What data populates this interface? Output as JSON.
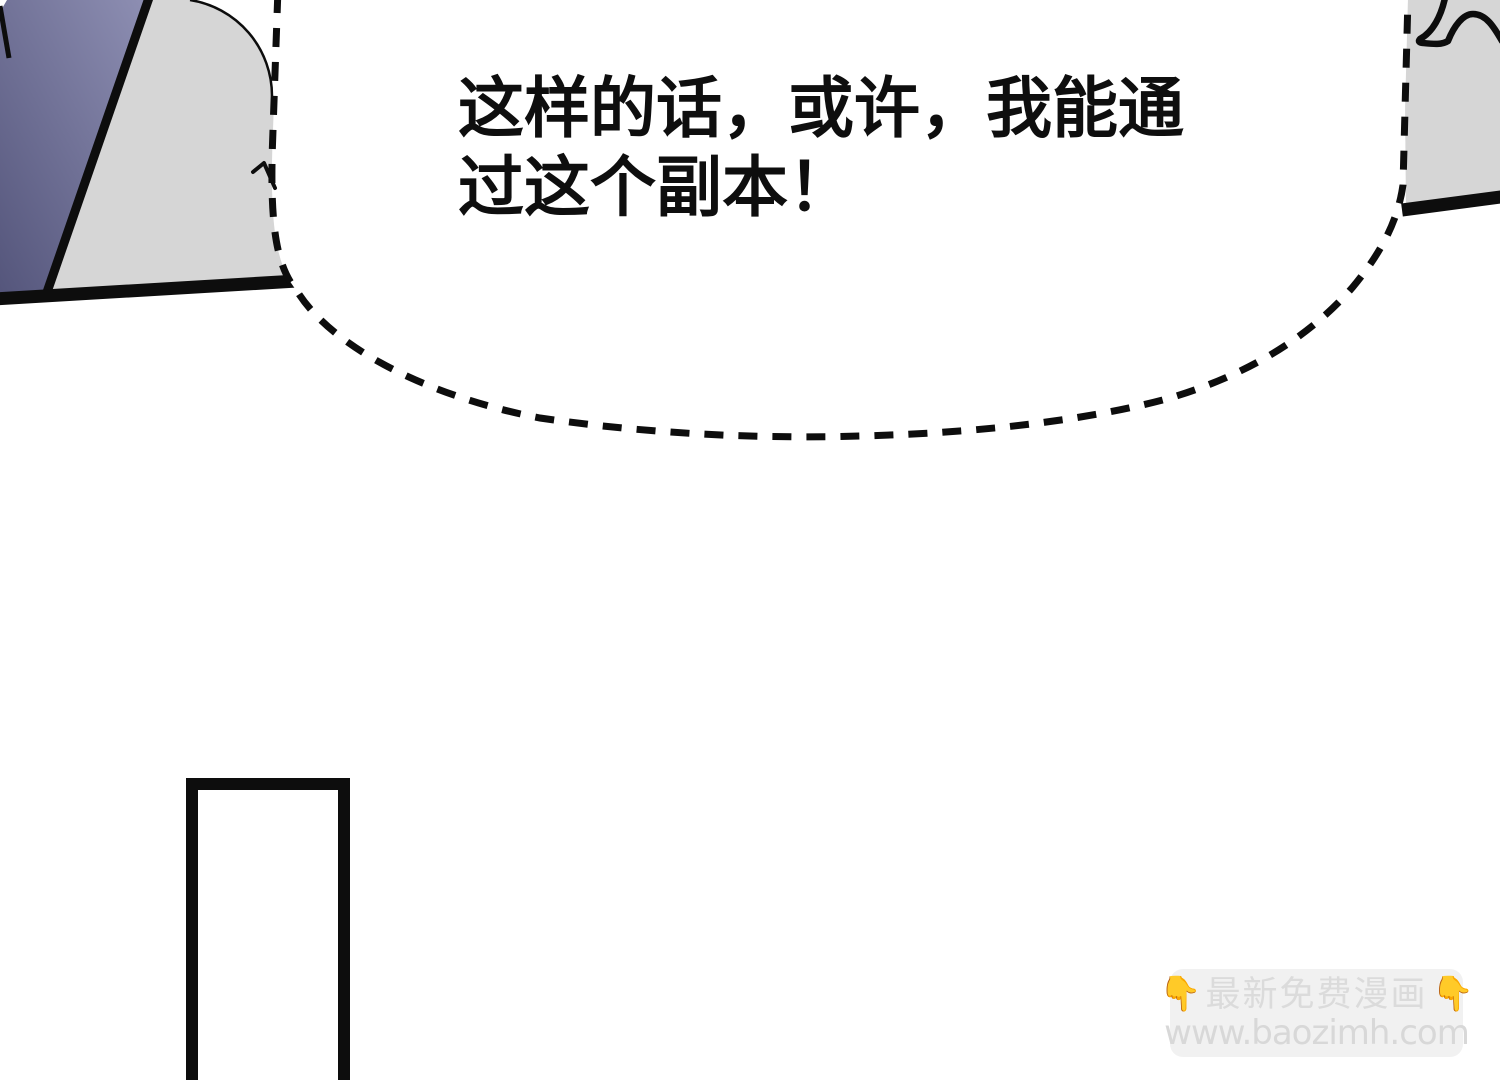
{
  "page": {
    "background": "#ffffff",
    "width": 1500,
    "height": 1080
  },
  "speech_bubble": {
    "text": "这样的话，或许，我能通\n过这个副本！",
    "fill": "#ffffff",
    "border_color": "#0d0d0d",
    "border_style": "dashed",
    "text_color": "#0e0e0e"
  },
  "art": {
    "panel_fill": "#d6d6d6",
    "ink_color": "#0d0d0d",
    "background_white": "#ffffff",
    "sword": {
      "color_dark": "#53547a",
      "color_light": "#8f90b4"
    }
  },
  "watermark": {
    "emoji_left": "👇",
    "title": "最新免费漫画",
    "emoji_right": "👇",
    "url": "www.baozimh.com",
    "background": "#f1f1f1",
    "text_color": "#dbdbdb",
    "emoji_color": "#f6c14b"
  }
}
